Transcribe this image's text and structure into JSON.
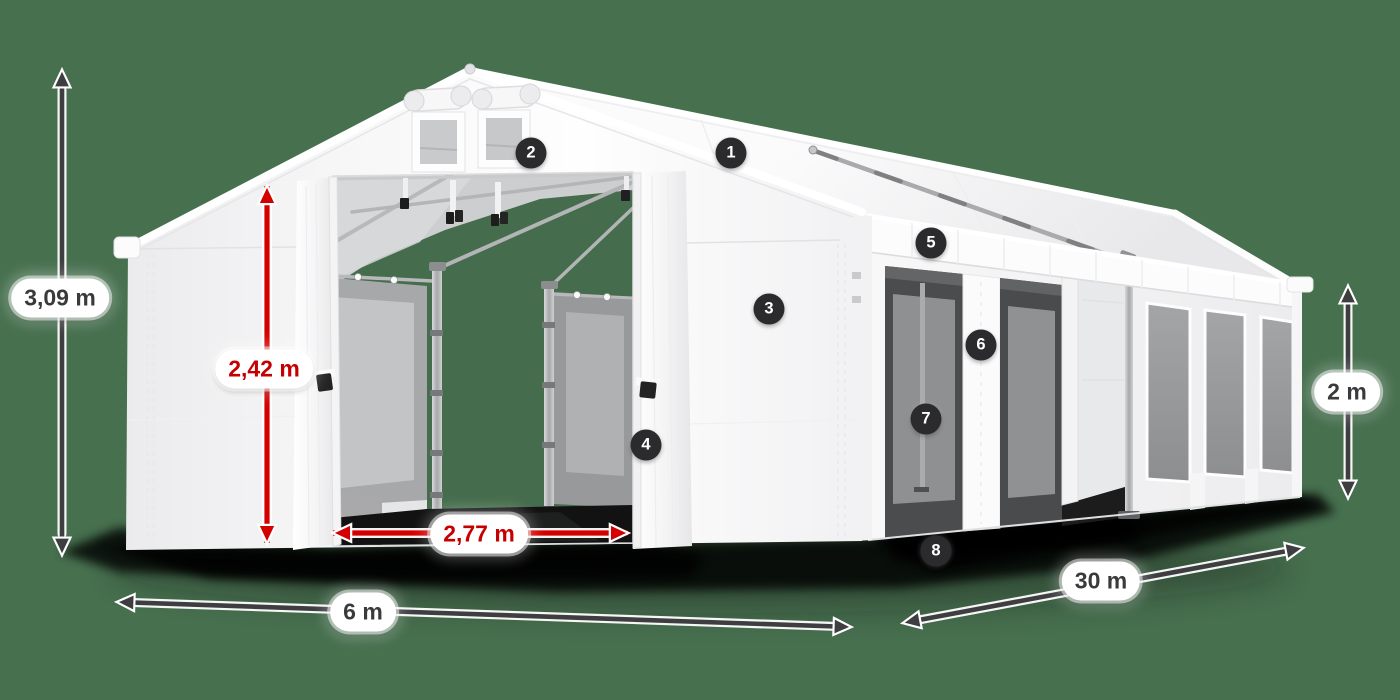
{
  "scene": {
    "description": "White PVC marquee tent shown in 3/4 view with open front doors, roof vents, side windows, dimension arrows and numbered part callouts",
    "background_color": "#47704f"
  },
  "dimension_labels": [
    {
      "id": "total-height",
      "text": "3,09 m",
      "style": "dark"
    },
    {
      "id": "door-height",
      "text": "2,42 m",
      "style": "red"
    },
    {
      "id": "door-width",
      "text": "2,77 m",
      "style": "red"
    },
    {
      "id": "gable-width",
      "text": "6 m",
      "style": "dark"
    },
    {
      "id": "length",
      "text": "30 m",
      "style": "dark"
    },
    {
      "id": "side-height",
      "text": "2 m",
      "style": "dark"
    }
  ],
  "callouts": [
    {
      "number": "1"
    },
    {
      "number": "2"
    },
    {
      "number": "3"
    },
    {
      "number": "4"
    },
    {
      "number": "5"
    },
    {
      "number": "6"
    },
    {
      "number": "7"
    },
    {
      "number": "8"
    }
  ],
  "colors": {
    "background": "#47704f",
    "arrow_dark": "#3e3e40",
    "arrow_red": "#d40000",
    "label_text_dark": "#3a3a3c",
    "label_text_red": "#c60000",
    "badge_background": "#2b2b2d",
    "badge_text": "#ffffff",
    "tent_fabric": "#fbfbfc",
    "ground_shadow": "#000000"
  }
}
